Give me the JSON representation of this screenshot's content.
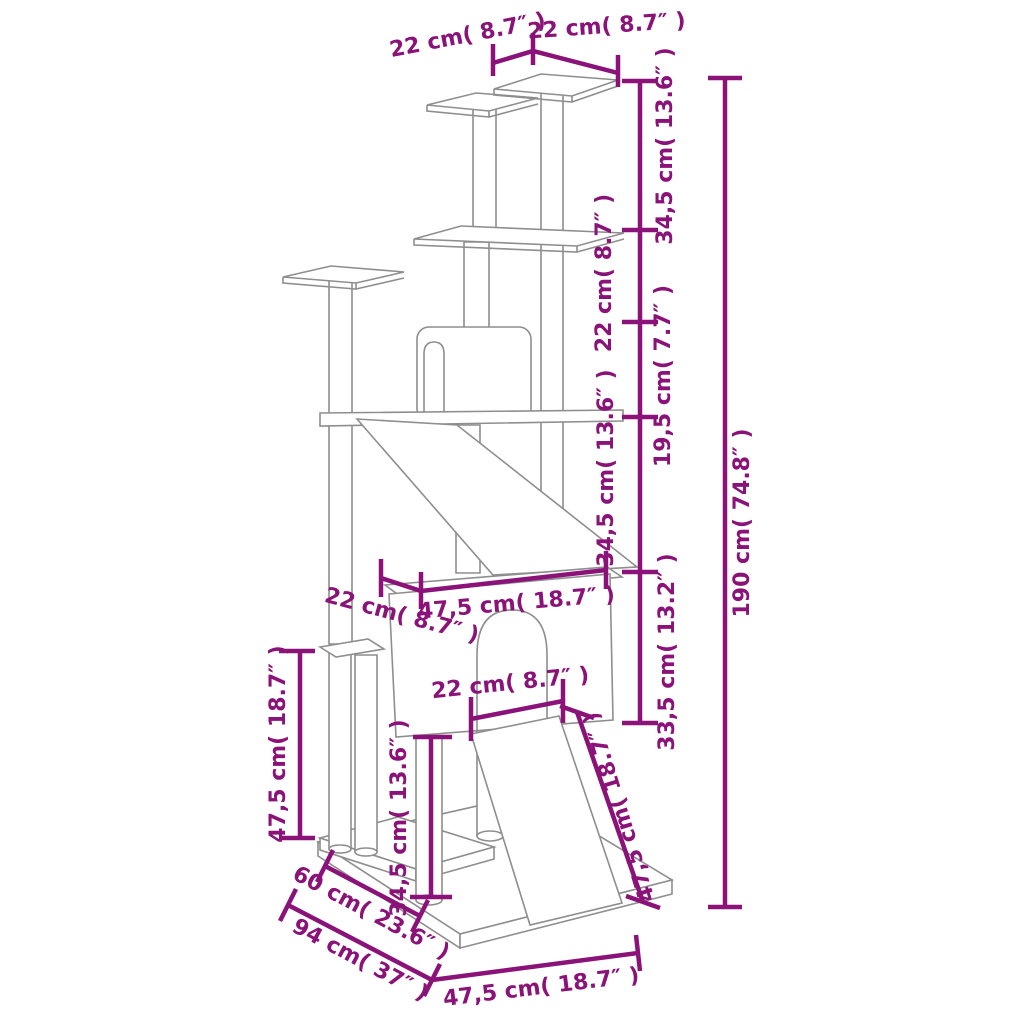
{
  "title": "Cat tree with scratching posts — dimension diagram",
  "colors": {
    "dimension": "#8A1278",
    "structure": "#8E8E8E",
    "background": "#FFFFFF"
  },
  "dimensions": {
    "top_platform_left_width": "22 cm( 8.7″ )",
    "top_platform_right_width": "22 cm( 8.7″ )",
    "level1_height": "34,5 cm( 13.6″ )",
    "level2_height": "22 cm( 8.7″ )",
    "level3_height": "19,5 cm( 7.7″ )",
    "level4_height": "34,5 cm( 13.6″ )",
    "condo_height": "33,5 cm( 13.2″ )",
    "total_height": "190 cm( 74.8″ )",
    "condo_width": "47,5 cm( 18.7″ )",
    "condo_offset": "22 cm( 8.7″ )",
    "door_width": "22 cm( 8.7″ )",
    "ramp_length": "47,5 cm( 18.7″ )",
    "left_post_height": "47,5 cm( 18.7″ )",
    "lower_post_height": "34,5 cm( 13.6″ )",
    "base_depth": "60 cm( 23.6″ )",
    "base_diagonal": "94 cm( 37″ )",
    "base_width": "47,5 cm( 18.7″ )"
  }
}
